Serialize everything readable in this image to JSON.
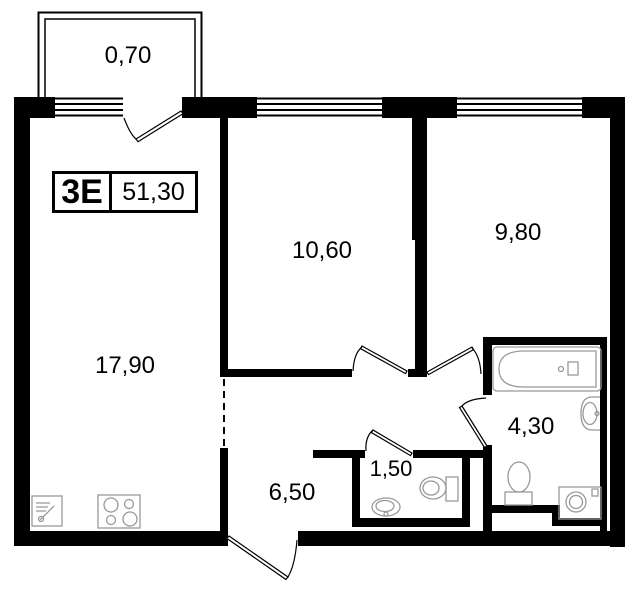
{
  "plan": {
    "unit_label": {
      "type": "3Е",
      "total_area": "51,30"
    },
    "rooms": {
      "balcony": "0,70",
      "living_kitchen": "17,90",
      "bedroom1": "10,60",
      "bedroom2": "9,80",
      "bathroom": "4,30",
      "wc": "1,50",
      "hallway": "6,50"
    },
    "colors": {
      "wall": "#000000",
      "background": "#ffffff",
      "fixture": "#999999",
      "text": "#000000"
    }
  }
}
